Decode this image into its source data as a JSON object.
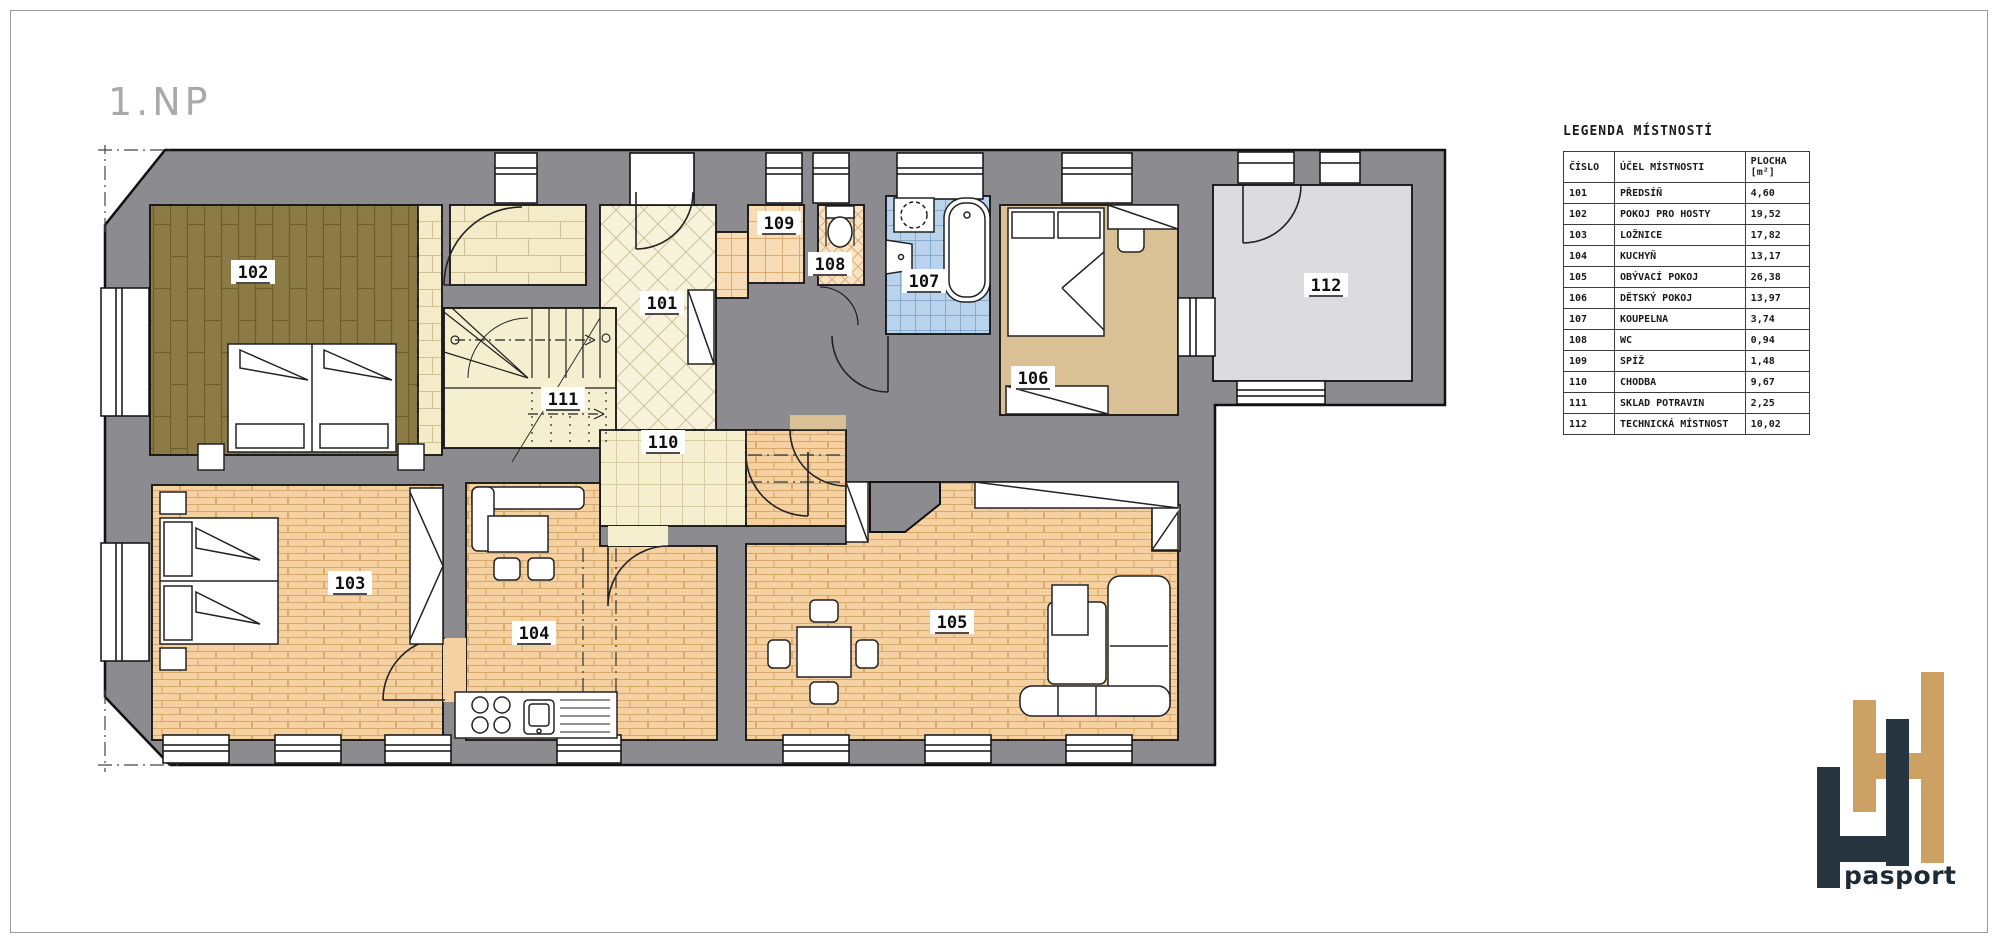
{
  "page": {
    "title": "1.NP"
  },
  "legend": {
    "title": "LEGENDA MÍSTNOSTÍ",
    "headers": {
      "number": "ČÍSLO",
      "purpose": "ÚČEL MÍSTNOSTI",
      "area_line1": "PLOCHA",
      "area_line2": "[m²]"
    },
    "rows": [
      {
        "number": "101",
        "purpose": "PŘEDSÍŇ",
        "area": "4,60"
      },
      {
        "number": "102",
        "purpose": "POKOJ PRO HOSTY",
        "area": "19,52"
      },
      {
        "number": "103",
        "purpose": "LOŽNICE",
        "area": "17,82"
      },
      {
        "number": "104",
        "purpose": "KUCHYŇ",
        "area": "13,17"
      },
      {
        "number": "105",
        "purpose": "OBÝVACÍ POKOJ",
        "area": "26,38"
      },
      {
        "number": "106",
        "purpose": "DĚTSKÝ POKOJ",
        "area": "13,97"
      },
      {
        "number": "107",
        "purpose": "KOUPELNA",
        "area": "3,74"
      },
      {
        "number": "108",
        "purpose": "WC",
        "area": "0,94"
      },
      {
        "number": "109",
        "purpose": "SPÍŽ",
        "area": "1,48"
      },
      {
        "number": "110",
        "purpose": "CHODBA",
        "area": "9,67"
      },
      {
        "number": "111",
        "purpose": "SKLAD POTRAVIN",
        "area": "2,25"
      },
      {
        "number": "112",
        "purpose": "TECHNICKÁ MÍSTNOST",
        "area": "10,02"
      }
    ]
  },
  "logo": {
    "text": "pasport",
    "tan_color": "#cda164",
    "dark_color": "#263540"
  },
  "colors": {
    "wall": "#8b8b90",
    "outline": "#111111",
    "floor_brick": "#f5d0a0",
    "floor_tan": "#d9c095",
    "floor_olive": "#8c7b44",
    "floor_cream": "#f6efcf",
    "floor_blue": "#b9d3ec",
    "floor_gray": "#dcdce0"
  }
}
